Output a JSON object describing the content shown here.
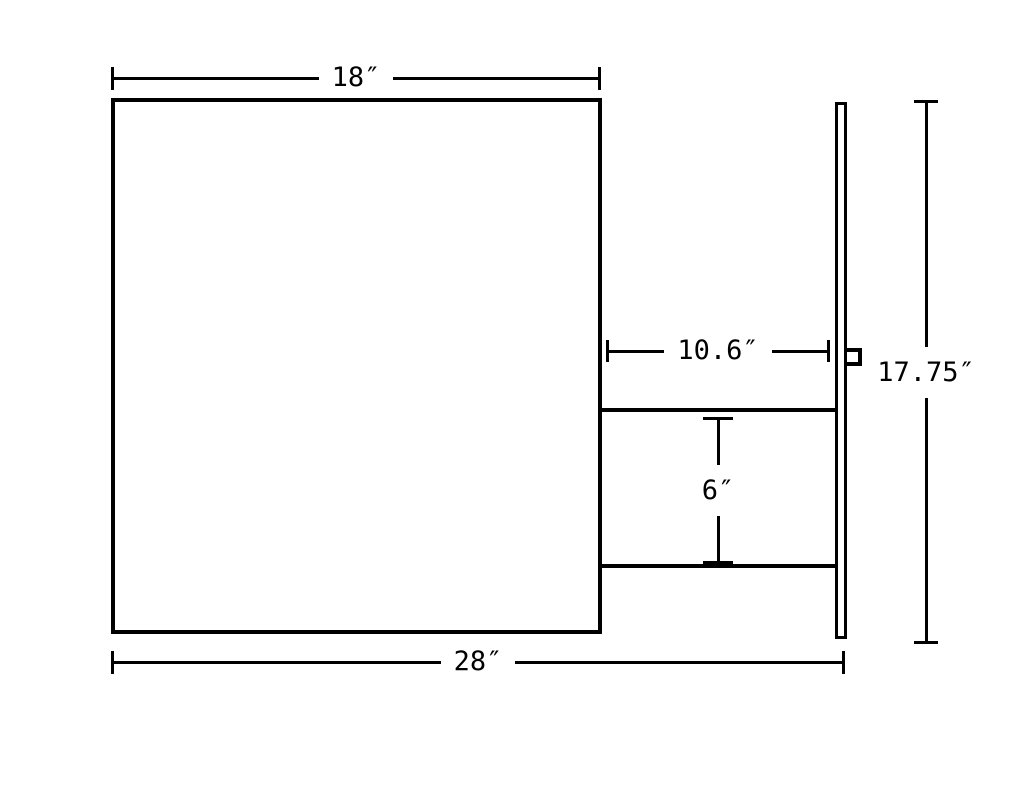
{
  "drawing": {
    "background_color": "#ffffff",
    "line_color": "#000000",
    "dimensions": {
      "top_width": {
        "label": "18″",
        "value": 18,
        "unit": "in"
      },
      "overall_width": {
        "label": "28″",
        "value": 28,
        "unit": "in"
      },
      "recess_depth": {
        "label": "10.6″",
        "value": 10.6,
        "unit": "in"
      },
      "opening_height": {
        "label": "6″",
        "value": 6,
        "unit": "in"
      },
      "overall_height": {
        "label": "17.75″",
        "value": 17.75,
        "unit": "in"
      }
    }
  }
}
